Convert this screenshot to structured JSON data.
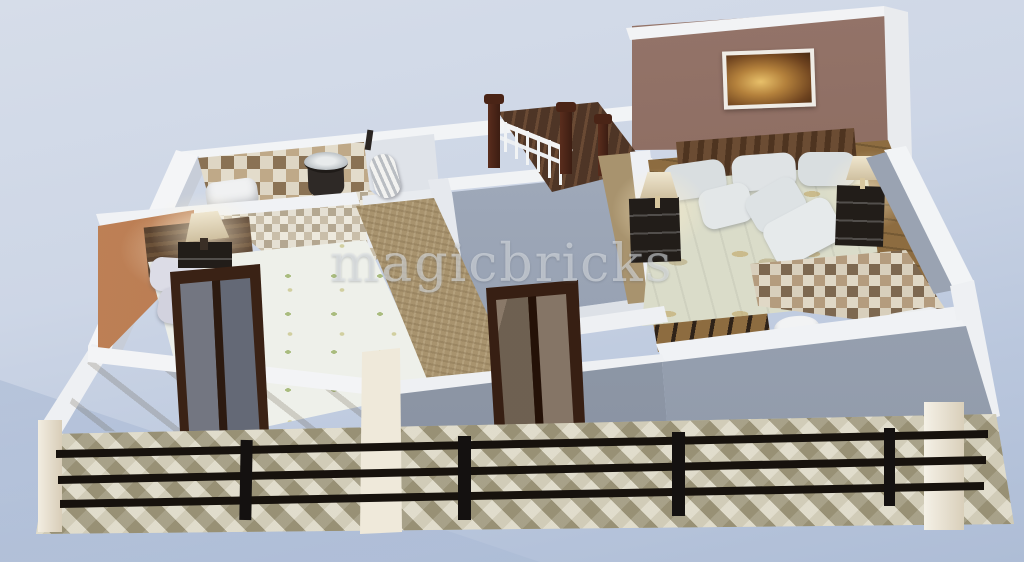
{
  "scene": {
    "type": "3d-floor-plan-render",
    "watermark": "magicbricks",
    "palette": {
      "sky_top": "#d6dde9",
      "sky_bottom": "#aebdd6",
      "wall_white": "#f2f4f6",
      "wall_shadow": "#8e98a9",
      "outer_wall_cream": "#efe7d6",
      "master_accent_wall": "#8d6e62",
      "bedroom_accent_wall": "#b3794f",
      "hall_floor": "#a8936e",
      "wood_floor": "#8d6c40",
      "tile_dark": "#8a7254",
      "tile_light": "#e3dccb",
      "balcony_tile_olive": "#9a9372",
      "balcony_tile_cream": "#d6d0bd",
      "railing_black": "#17120d",
      "door_frame": "#3a2215",
      "stair_wood": "#4e3526",
      "lamp_glow": "#fff0cd",
      "duvet_master": "#dadcc9",
      "duvet_left": "#eef0ea",
      "painting_gold": "#c89a52"
    },
    "rooms": [
      {
        "id": "bathroom-top-left",
        "furniture": [
          "bathtub",
          "pedestal-washbasin",
          "checker-tile-wall",
          "checker-tile-floor"
        ]
      },
      {
        "id": "linen-closet",
        "furniture": [
          "towel-stack"
        ]
      },
      {
        "id": "bedroom-left",
        "furniture": [
          "double-bed-floral-duvet",
          "pillows",
          "wood-headboard",
          "nightstand",
          "table-lamp",
          "accent-wall-terracotta",
          "sliding-glass-door"
        ]
      },
      {
        "id": "hall-passage",
        "furniture": [
          "carpet-floor",
          "sliding-glass-door"
        ]
      },
      {
        "id": "staircase",
        "furniture": [
          "wood-newel-posts",
          "white-balusters",
          "handrail",
          "dark-treads",
          "stairwell-shaft"
        ]
      },
      {
        "id": "master-bedroom",
        "furniture": [
          "double-bed-leaf-duvet",
          "pillows",
          "wood-headboard",
          "nightstand-left",
          "nightstand-right",
          "table-lamp-left",
          "table-lamp-right",
          "framed-painting",
          "accent-wall-mauve",
          "wood-floor",
          "rug"
        ]
      },
      {
        "id": "bathroom-right",
        "furniture": [
          "toilet",
          "bathtub",
          "checker-tile-wall"
        ]
      },
      {
        "id": "balcony",
        "furniture": [
          "diamond-tile-floor",
          "black-railing-three-bars",
          "railing-posts",
          "white-pillars",
          "divider-wall"
        ]
      }
    ]
  }
}
